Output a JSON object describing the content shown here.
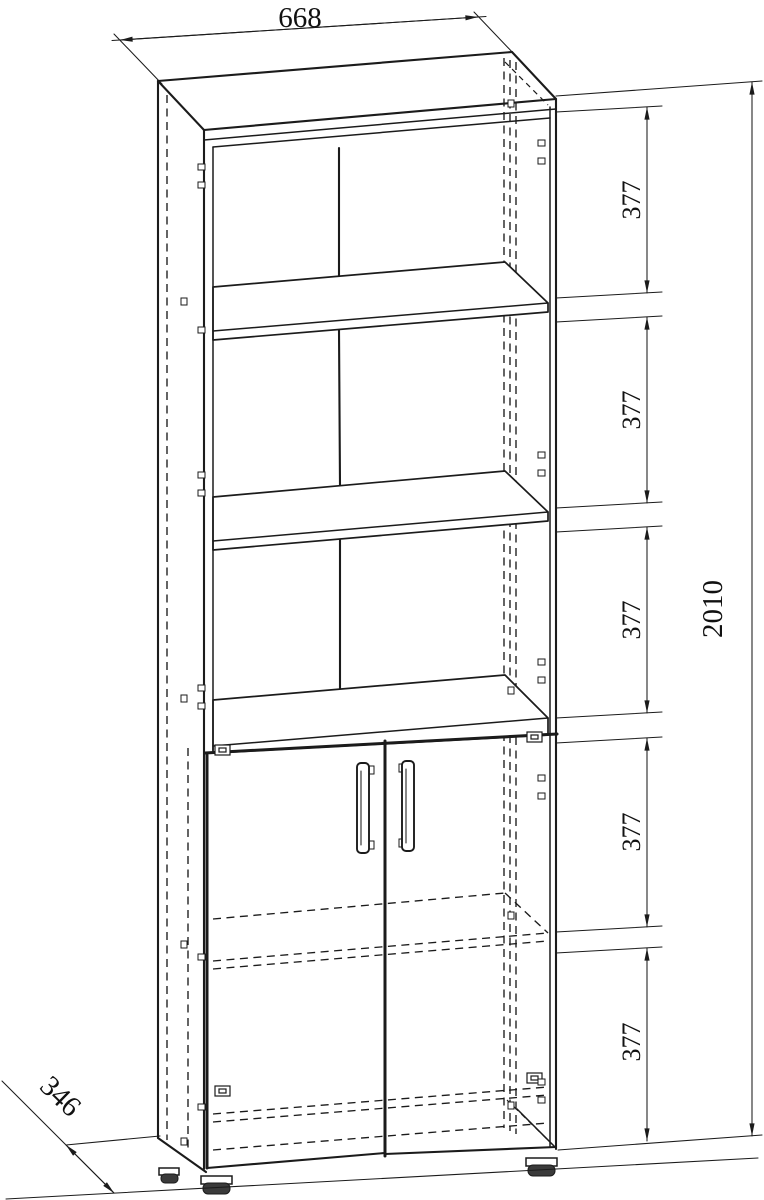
{
  "colors": {
    "background": "#ffffff",
    "line": "#1b1b1b"
  },
  "drawing": {
    "object": "tall cabinet with open shelves and two lower doors",
    "view": "axonometric front-left technical drawing",
    "dimensions": {
      "width": "668",
      "overall_height": "2010",
      "depth": "346",
      "section_heights": [
        "377",
        "377",
        "377",
        "377",
        "377"
      ]
    }
  }
}
